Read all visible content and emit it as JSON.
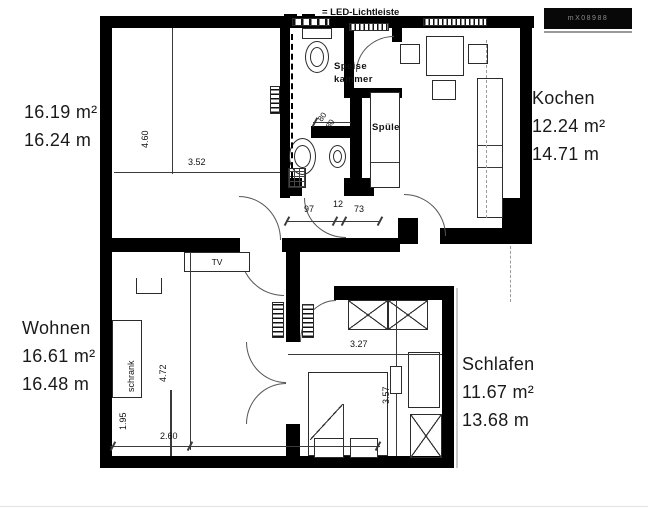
{
  "legend": {
    "led_label": "= LED-Lichtleiste"
  },
  "logo_badge": {
    "text": "mX08988"
  },
  "rooms": {
    "dining": {
      "area": "16.19 m²",
      "perimeter": "16.24 m"
    },
    "kitchen": {
      "name": "Kochen",
      "area": "12.24 m²",
      "perimeter": "14.71 m"
    },
    "living": {
      "name": "Wohnen",
      "area": "16.61 m²",
      "perimeter": "16.48 m"
    },
    "bedroom": {
      "name": "Schlafen",
      "area": "11.67 m²",
      "perimeter": "13.68 m"
    }
  },
  "labels": {
    "pantry_line1": "Speise",
    "pantry_line2": "kammer",
    "sink": "Spüle",
    "tv": "TV",
    "wardrobe": "schrank"
  },
  "dimensions": {
    "dining_height": "4.60",
    "dining_width": "3.52",
    "hall_a": "97",
    "hall_b": "12",
    "hall_c": "73",
    "niche_w": "80",
    "niche_d": "80",
    "living_height": "4.72",
    "living_nook": "1.95",
    "living_width": "2.60",
    "bedroom_width": "3.27",
    "bedroom_height": "3.57"
  }
}
